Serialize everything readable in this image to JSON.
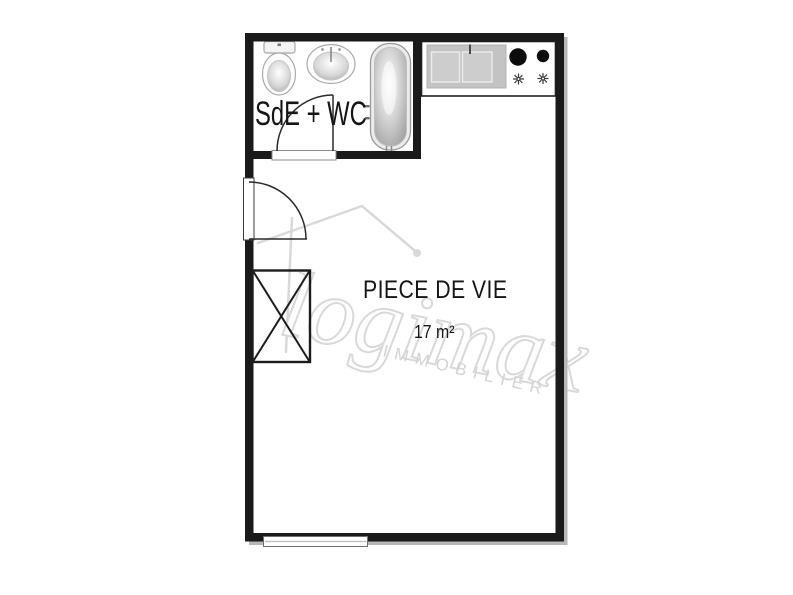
{
  "plan": {
    "rooms": {
      "bathroom": {
        "label": "SdE + WC"
      },
      "living": {
        "label": "PIECE DE VIE",
        "area": "17 m²"
      }
    },
    "fixtures": {
      "bathroom": [
        "toilet",
        "washbasin",
        "bathtub"
      ],
      "kitchen": [
        "double-sink",
        "large-burner",
        "small-burner"
      ],
      "storage": [
        "closet"
      ]
    },
    "openings": [
      "entrance-door",
      "bathroom-door",
      "window"
    ]
  },
  "watermark": {
    "brand": "logimax",
    "subtitle": "IMMOBILIER"
  },
  "colors": {
    "wall": "#1a1a1a",
    "counter": "#c3c3c3",
    "watermark_stroke": "#d9d9d9",
    "watermark_text": "#d4d4d4",
    "shadow": "#b7b7b7"
  }
}
